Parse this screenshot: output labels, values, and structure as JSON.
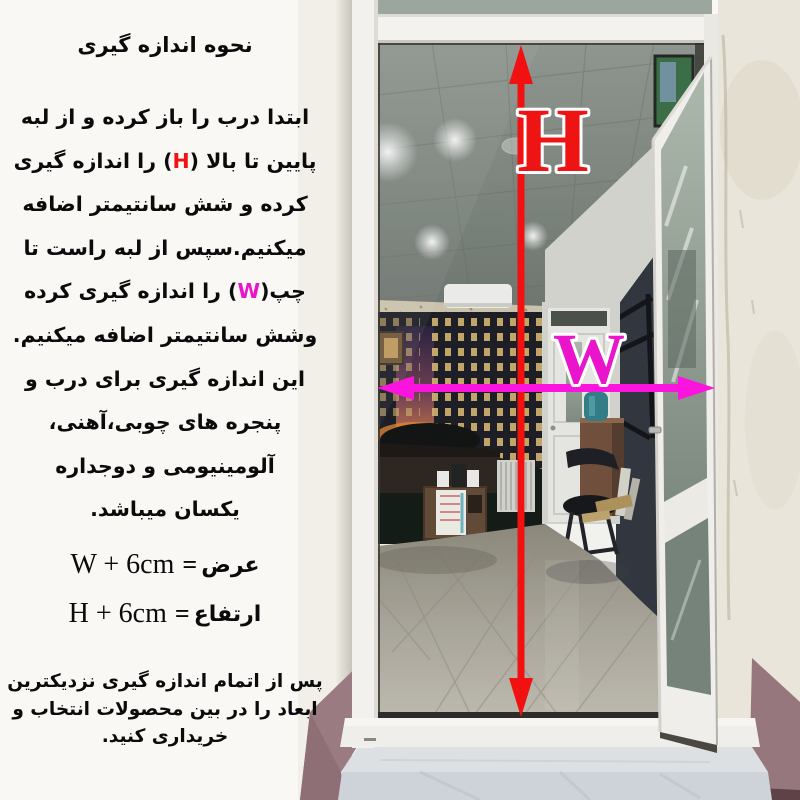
{
  "instructions": {
    "title": "نحوه اندازه گیری",
    "lines": [
      [
        {
          "t": "ابتدا درب را باز کرده و از لبه"
        }
      ],
      [
        {
          "t": "پایین تا بالا ("
        },
        {
          "t": "H",
          "c": "h"
        },
        {
          "t": ") را اندازه گیری"
        }
      ],
      [
        {
          "t": "کرده و شش سانتیمتر اضافه"
        }
      ],
      [
        {
          "t": "میکنیم.سپس از لبه راست تا"
        }
      ],
      [
        {
          "t": "چپ("
        },
        {
          "t": "W",
          "c": "w"
        },
        {
          "t": ") را اندازه گیری کرده"
        }
      ],
      [
        {
          "t": "وشش سانتیمتر اضافه میکنیم."
        }
      ],
      [
        {
          "t": "این اندازه گیری برای درب و"
        }
      ],
      [
        {
          "t": "پنجره های چوبی،آهنی،"
        }
      ],
      [
        {
          "t": "آلومینیومی و دوجداره"
        }
      ],
      [
        {
          "t": "یکسان میباشد."
        }
      ]
    ]
  },
  "formulas": {
    "width": {
      "latin": "W + 6cm",
      "eq": "=",
      "fa": "عرض"
    },
    "height": {
      "latin": "H + 6cm",
      "eq": "=",
      "fa": "ارتفاع"
    }
  },
  "footer": {
    "lines": [
      "پس از اتمام اندازه گیری نزدیکترین",
      "ابعاد را در بین محصولات انتخاب و",
      "خریداری کنید."
    ]
  },
  "diagram": {
    "h_label": "H",
    "w_label": "W",
    "h_color": "#ee1414",
    "w_color": "#ea14cc",
    "arrow_red": "#f21111",
    "arrow_magenta": "#fb13de"
  }
}
